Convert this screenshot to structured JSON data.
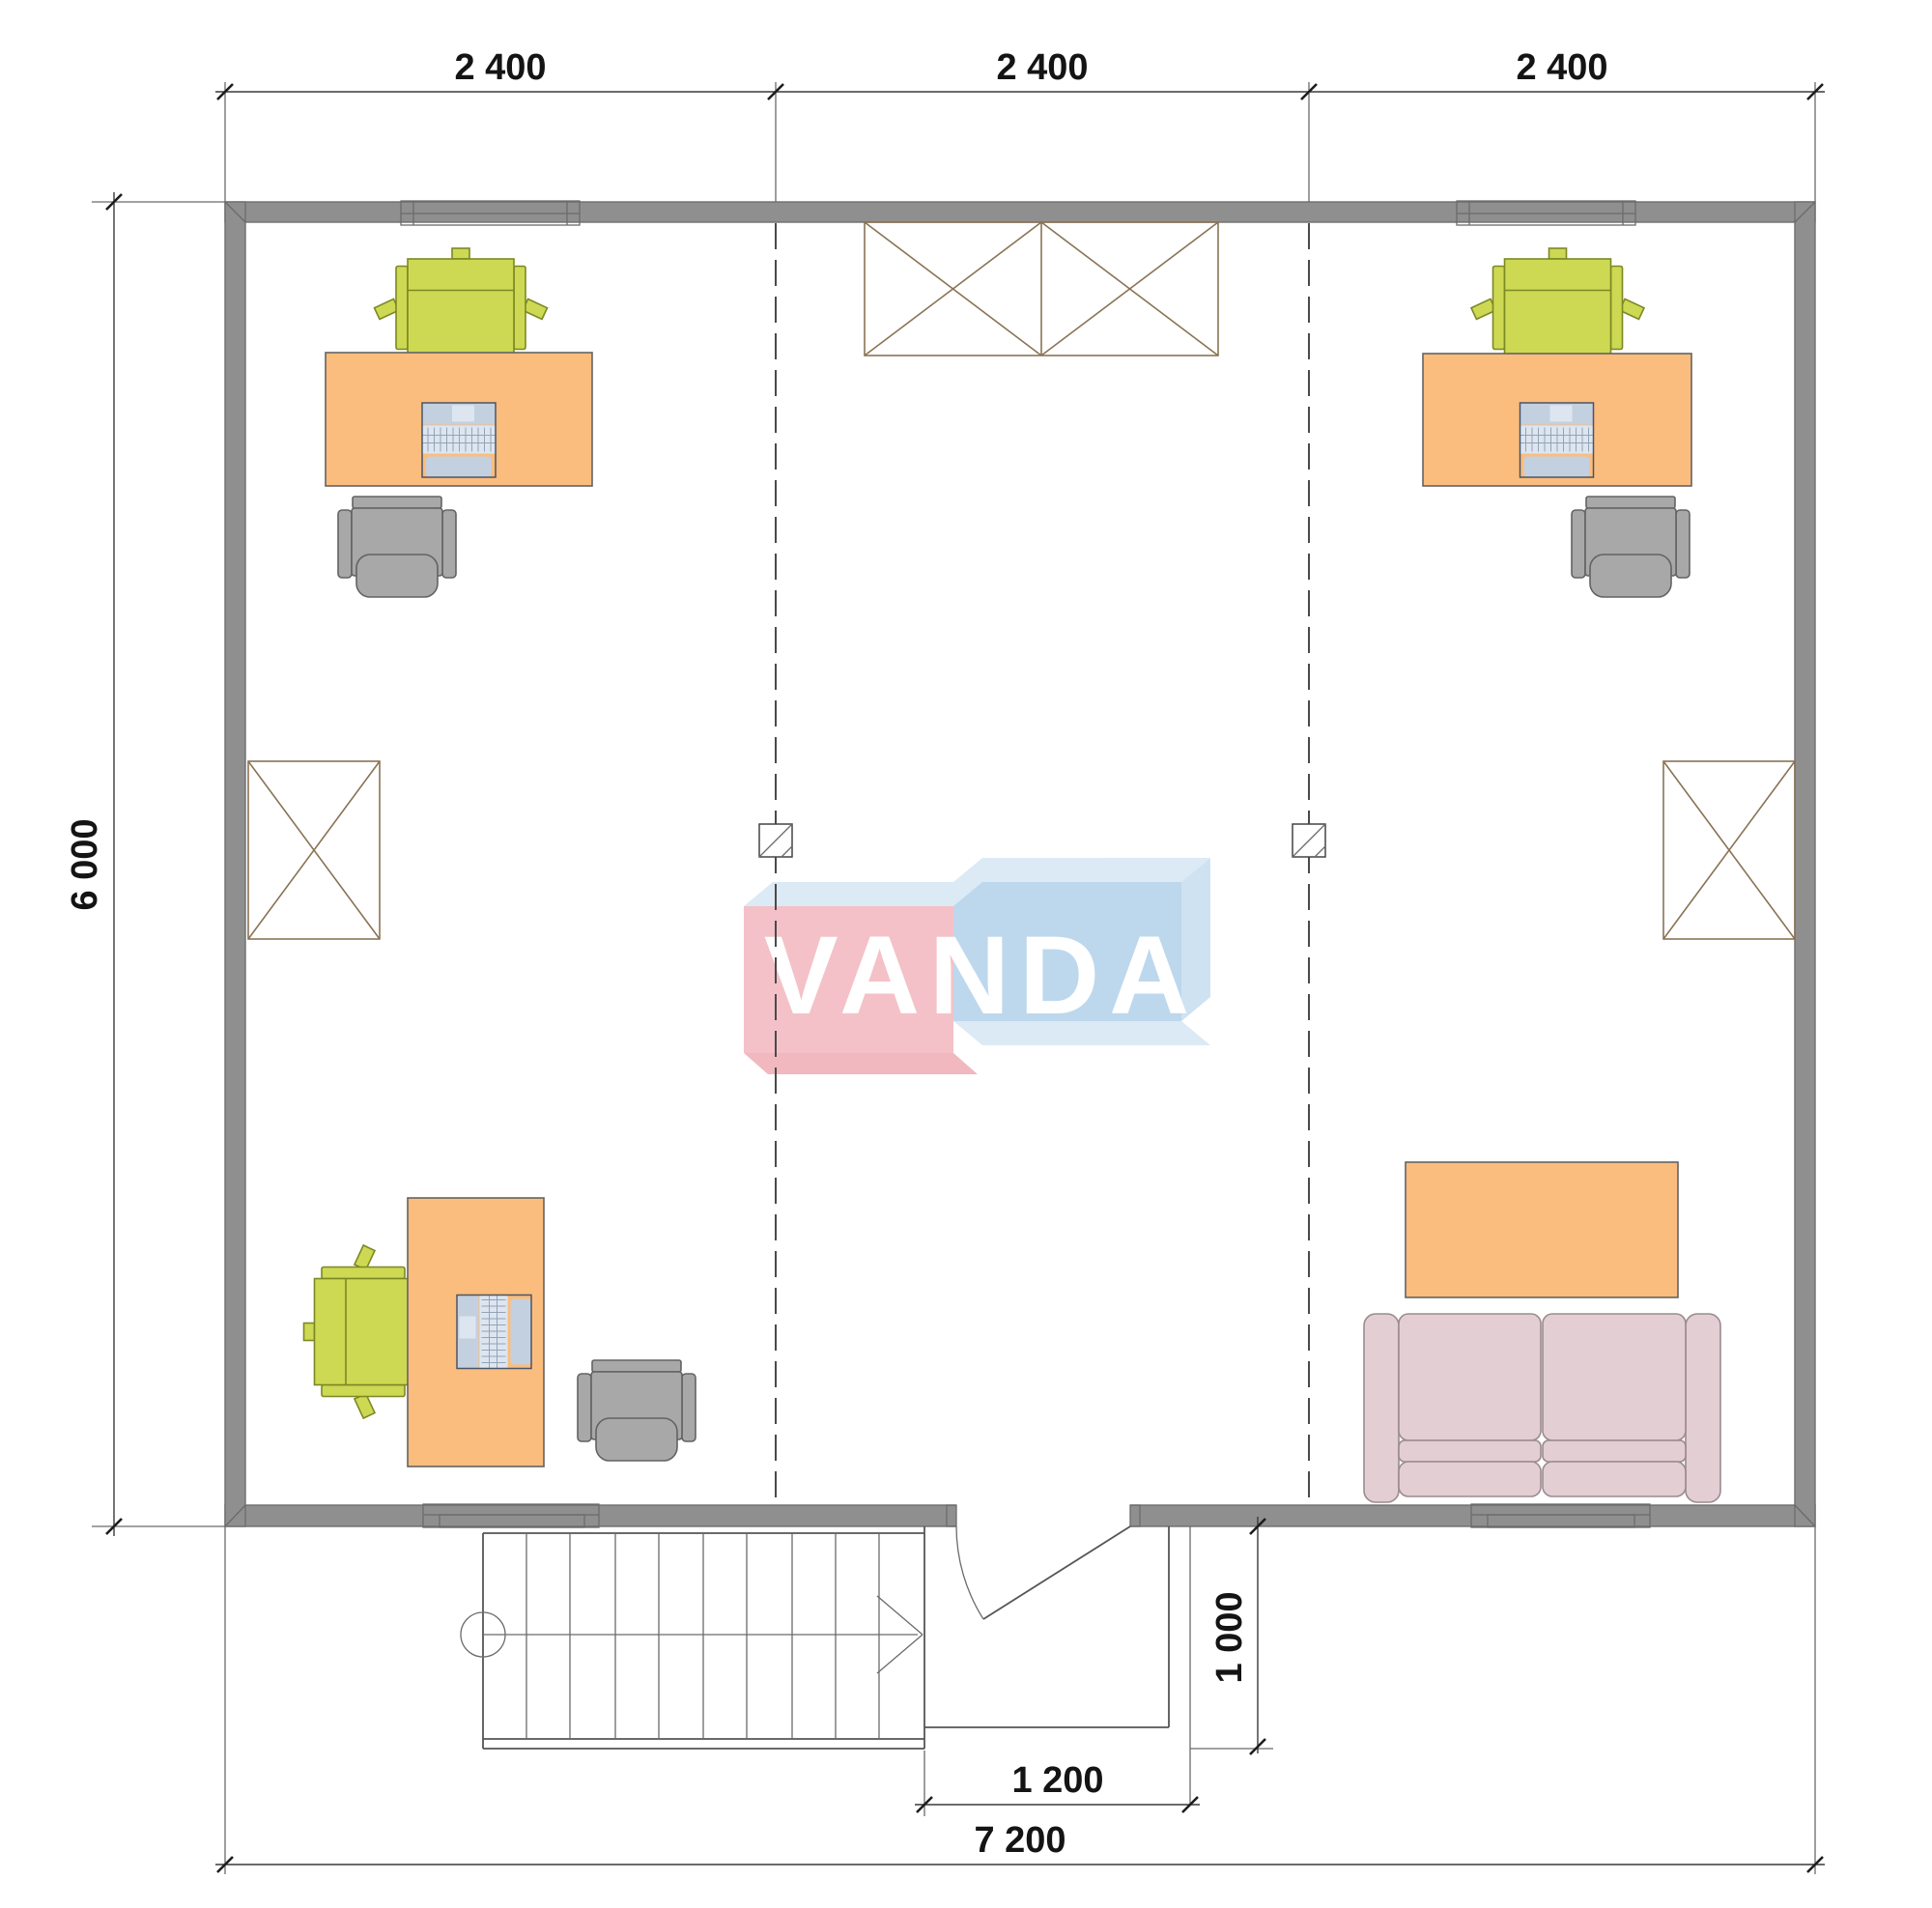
{
  "dimensions": {
    "top_segments": [
      "2 400",
      "2 400",
      "2 400"
    ],
    "side_height": "6 000",
    "bottom_total": "7 200",
    "entrance_width": "1 200",
    "entrance_depth": "1 000"
  },
  "watermark": {
    "logo_text": "VANDA"
  },
  "colors": {
    "wall": "#8f8f8f",
    "crate": "#c9aa80",
    "desk": "#fbbd7d",
    "chair_green": "#cdd952",
    "chair_gray": "#a8a8a8",
    "sofa": "#e2ced3",
    "device": "#c3d0e0",
    "device_light": "#dde6f0",
    "logo_pink": "#f4bdc4",
    "logo_pink_dark": "#f0b3bb",
    "logo_blue": "#b9d6ec",
    "logo_blue_side": "#cbe0f1",
    "logo_top": "#d9e9f5",
    "logo_text_color": "#ffffff"
  }
}
